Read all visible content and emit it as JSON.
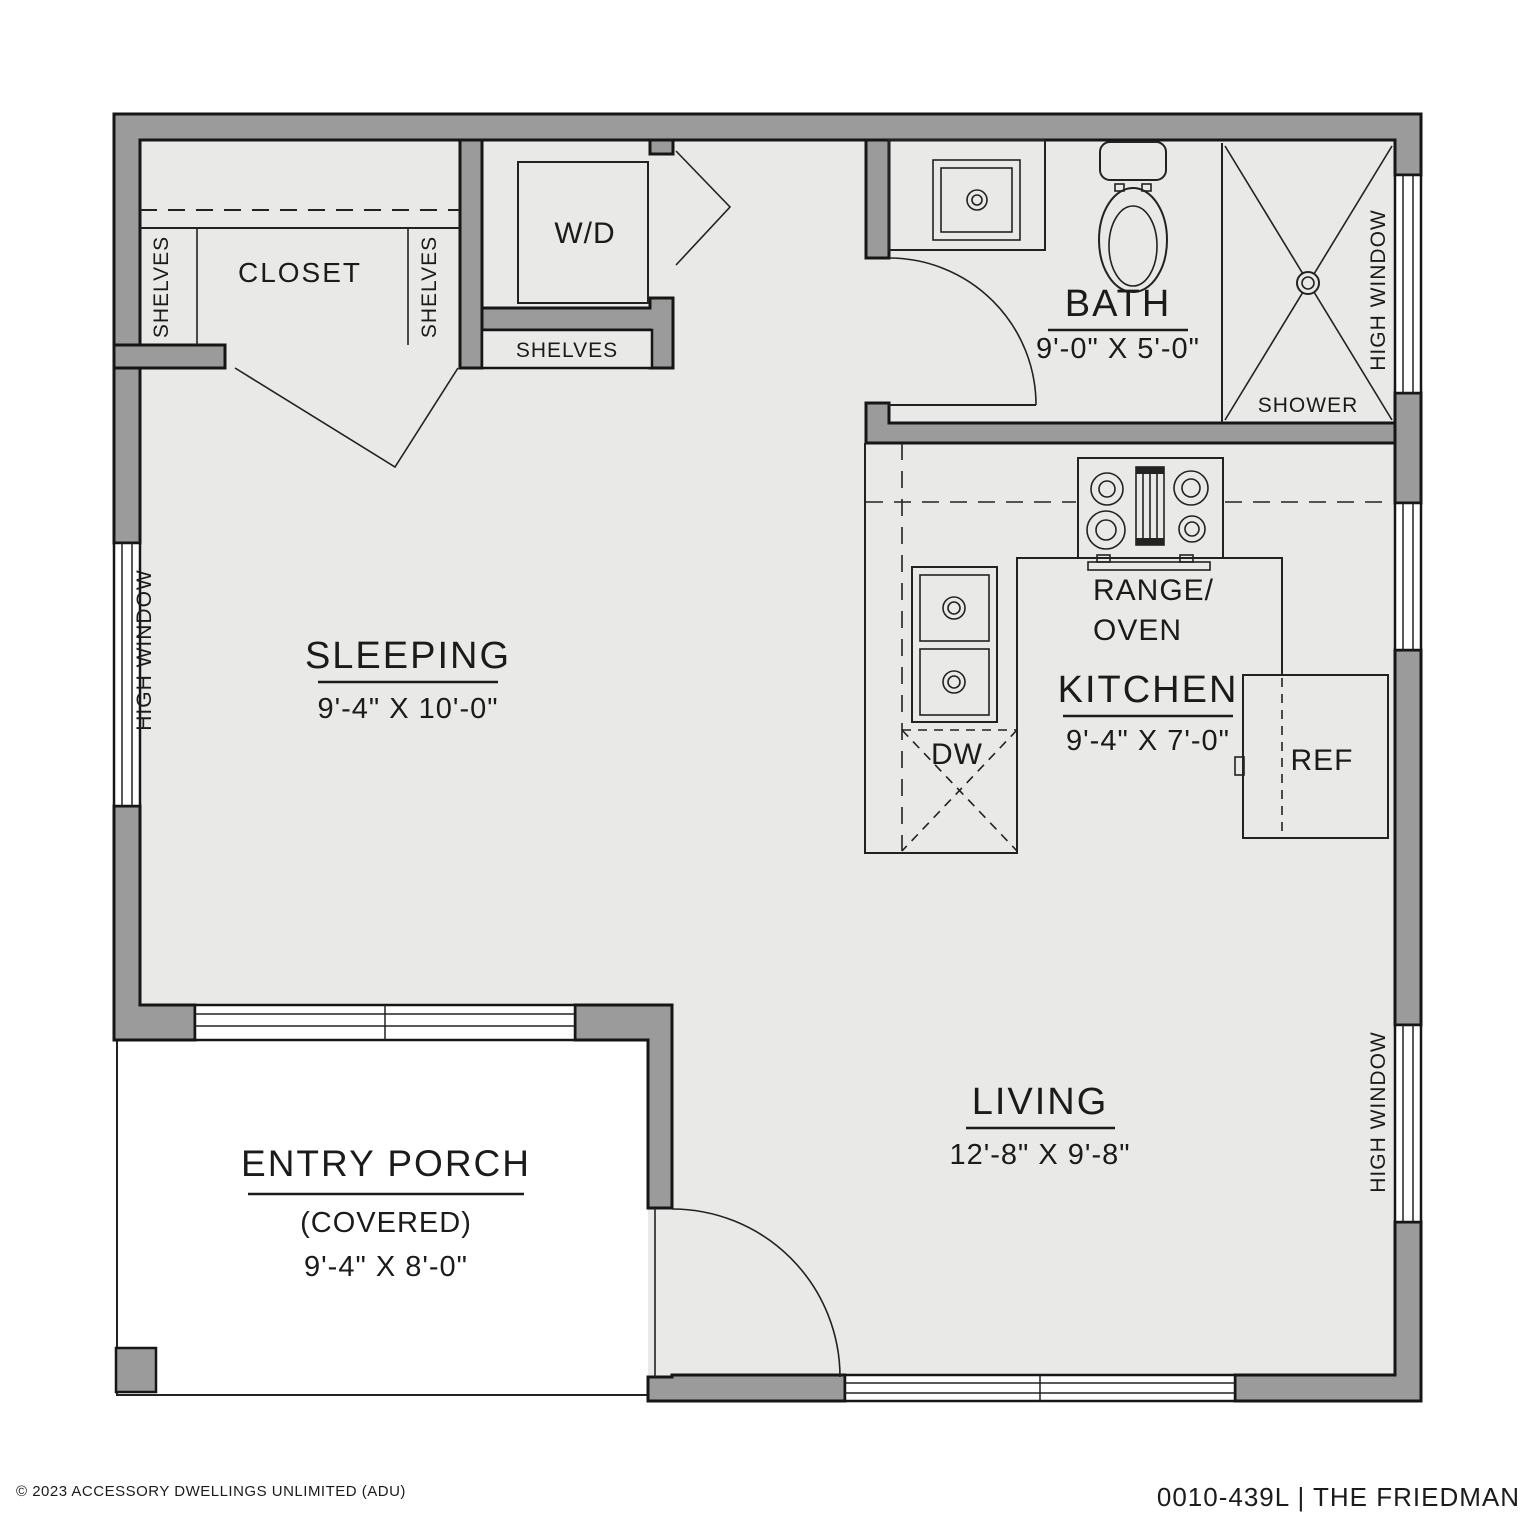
{
  "plan": {
    "footer": {
      "copyright": "© 2023 ACCESSORY DWELLINGS UNLIMITED (ADU)",
      "plan_id": "0010-439L | THE FRIEDMAN"
    },
    "rooms": {
      "sleeping": {
        "name": "SLEEPING",
        "dims": "9'-4\" X 10'-0\""
      },
      "bath": {
        "name": "BATH",
        "dims": "9'-0\" X 5'-0\""
      },
      "kitchen": {
        "name": "KITCHEN",
        "dims": "9'-4\" X 7'-0\""
      },
      "living": {
        "name": "LIVING",
        "dims": "12'-8\" X 9'-8\""
      },
      "entry_porch": {
        "name": "ENTRY PORCH",
        "subtitle": "(COVERED)",
        "dims": "9'-4\" X 8'-0\""
      },
      "closet": {
        "name": "CLOSET"
      }
    },
    "labels": {
      "washer_dryer": "W/D",
      "shelves_left": "SHELVES",
      "shelves_right": "SHELVES",
      "shelves_under_wd": "SHELVES",
      "shower": "SHOWER",
      "range_line1": "RANGE/",
      "range_line2": "OVEN",
      "dishwasher": "DW",
      "refrigerator": "REF",
      "high_window_left": "HIGH WINDOW",
      "high_window_bath": "HIGH WINDOW",
      "high_window_living": "HIGH WINDOW"
    },
    "colors": {
      "wall": "#9b9b9b",
      "wall_outline": "#161616",
      "floor": "#e9e9e7",
      "line": "#222222",
      "text": "#1b1b1b",
      "bg": "#ffffff"
    }
  }
}
